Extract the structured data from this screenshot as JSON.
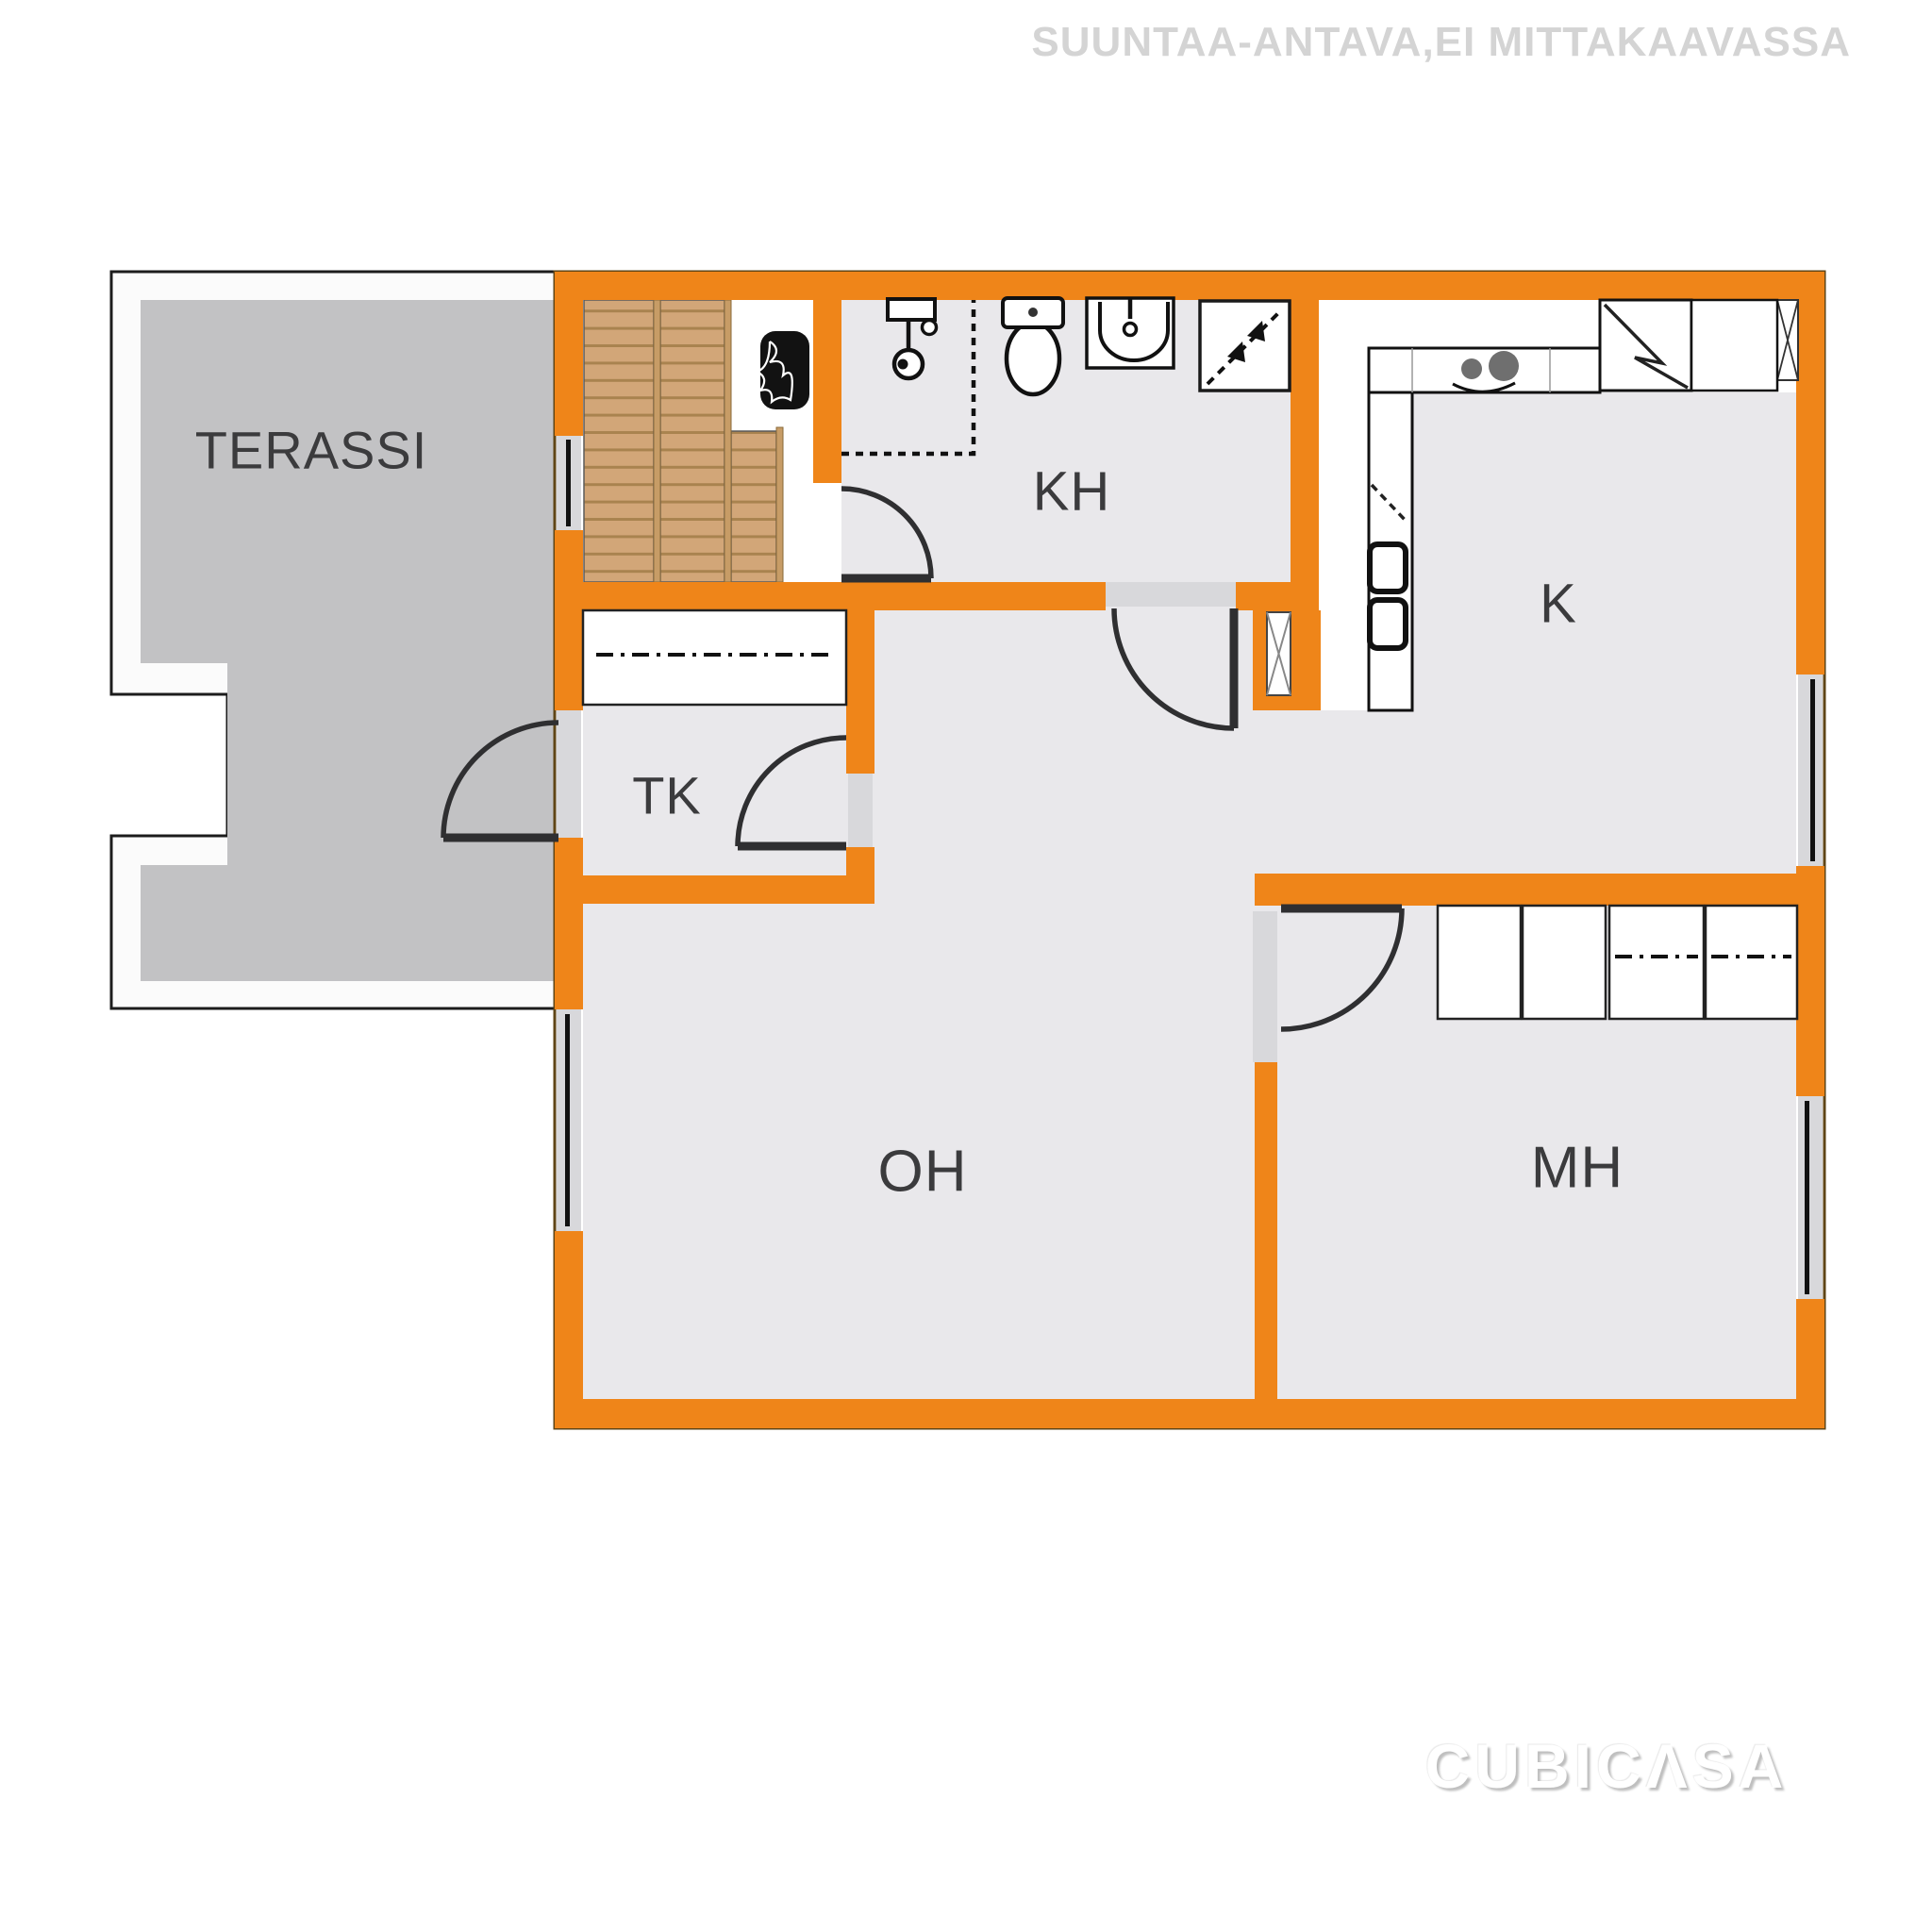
{
  "disclaimer": "SUUNTAA-ANTAVA,EI MITTAKAAVASSA",
  "watermark": "CUBICΛSA",
  "rooms": {
    "terassi": "TERASSI",
    "kh": "KH",
    "k": "K",
    "tk": "TK",
    "oh": "OH",
    "mh": "MH"
  },
  "colors": {
    "wall": "#EF8519",
    "room_floor": "#E9E8EB",
    "terrace_floor": "#C2C2C4",
    "terrace_border": "#FBFBFB",
    "stair_wood": "#D2A678",
    "stair_tread_line": "#A9834F",
    "door_symbol": "#2F2F31",
    "window_glass": "#111111",
    "opening_fill": "#D8D8DB",
    "label_text": "#3B3B3D",
    "disclaimer_text": "#D4D4D4",
    "watermark_text": "#FFFFFF"
  }
}
